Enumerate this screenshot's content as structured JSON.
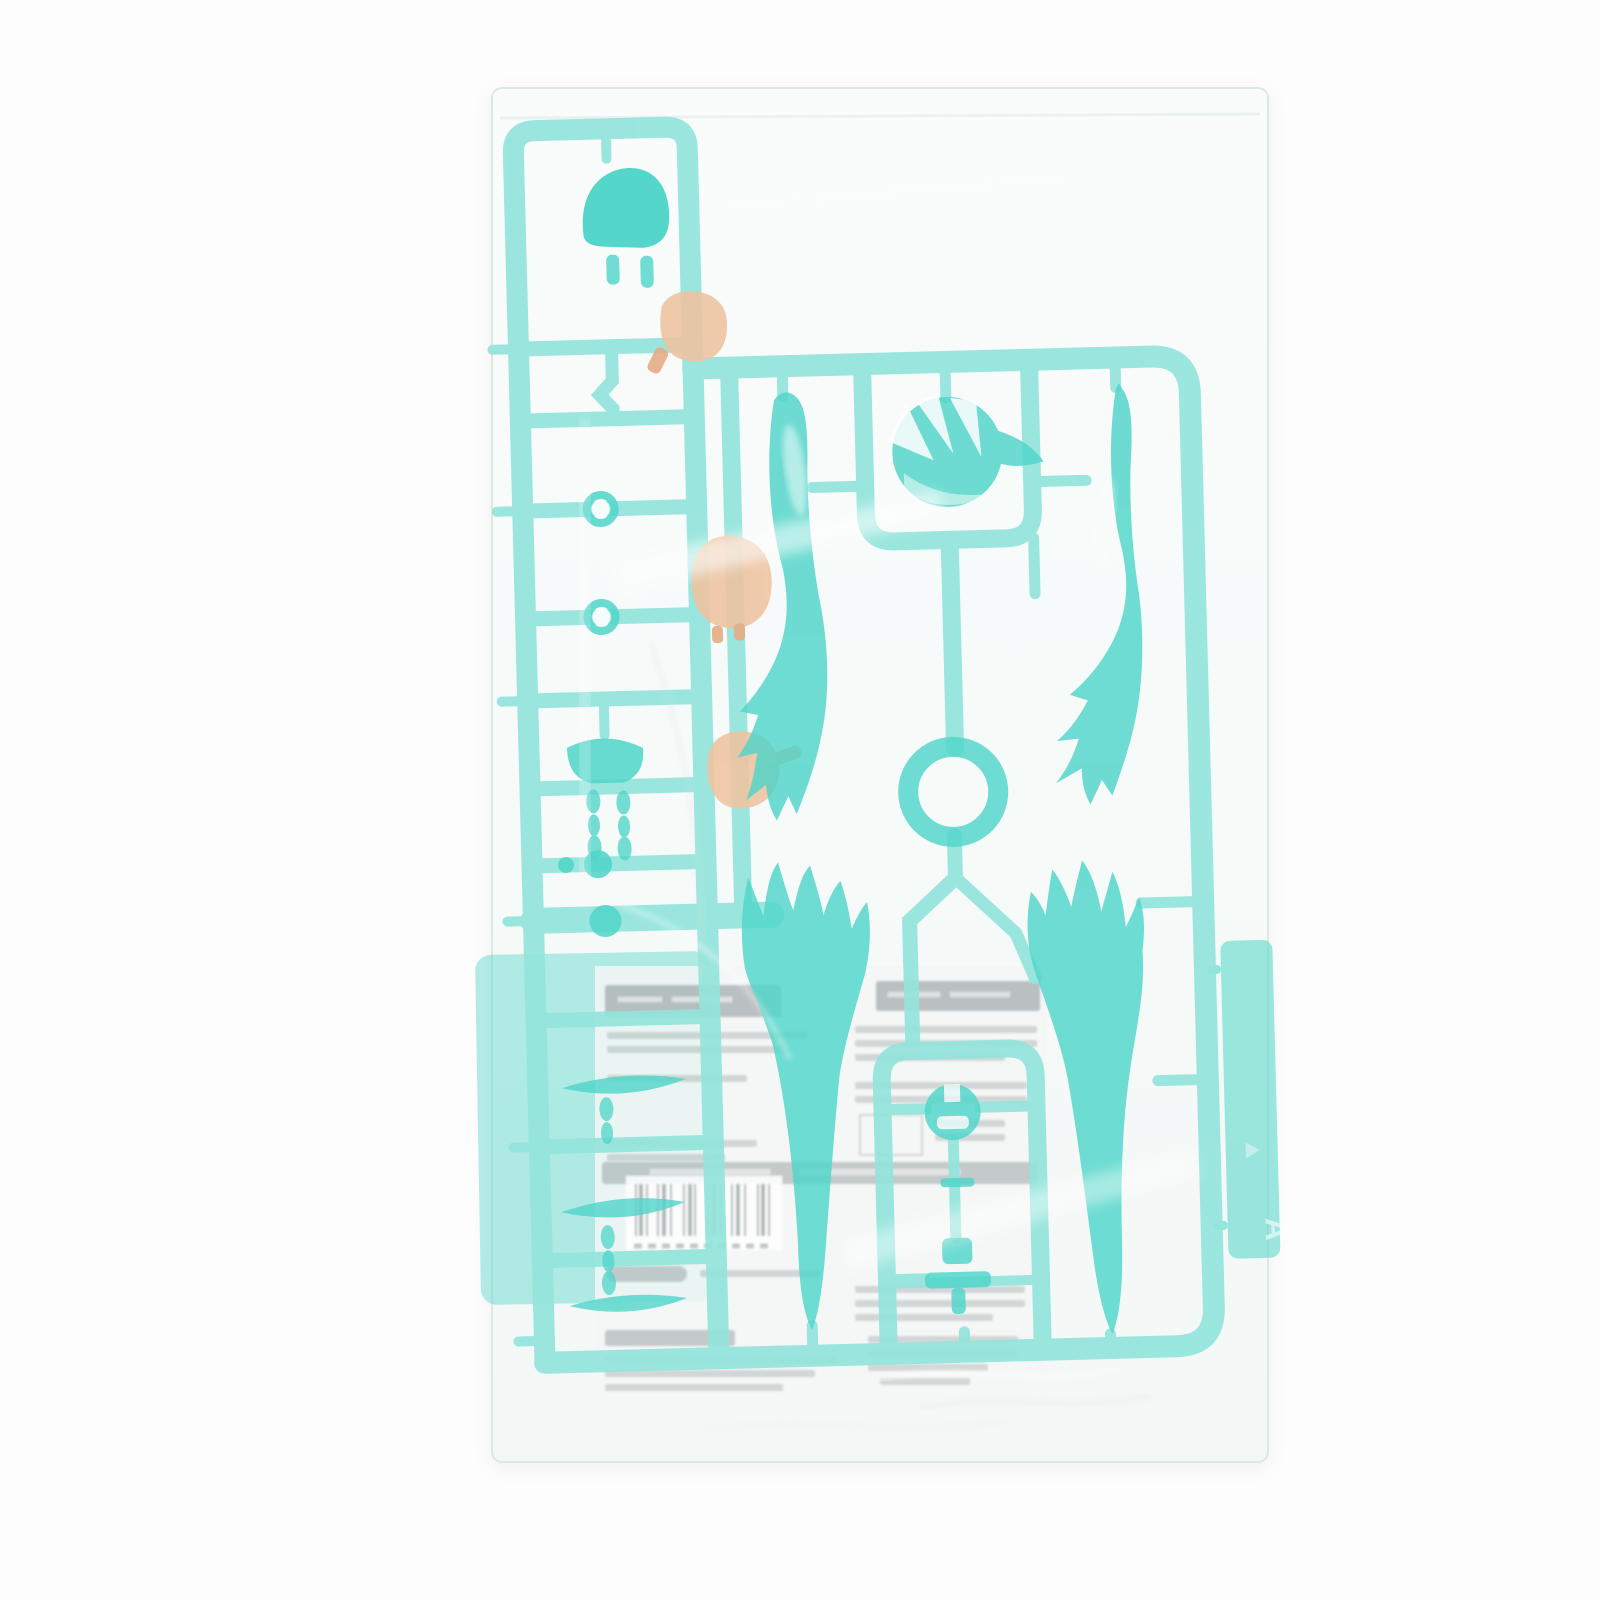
{
  "meta": {
    "title": "Sealed model-kit runner — product photo",
    "description": "Product photo of a translucent teal plastic model-kit runner (sprue A) sealed in a clear plastic bag. The runner carries anime-figure parts: a swirled front-hair piece, two long twin-tail hair pieces, two flame-shaped lower hair pieces, a round joint ring, a small hair clip and joint pieces, plus three skin-tone head parts. A folded instruction leaflet with a barcode shows through the bag, mirrored and illegible."
  },
  "colors": {
    "background": "#fdfdfd",
    "bag": "#f8fbfa",
    "bag_edge": "#dfe7e5",
    "rail": "#93e5dc",
    "part": "#4fd5c9",
    "part_deep": "#3ed0c4",
    "plate": "#5cd8cc",
    "skin": "#eec4a2",
    "skin_deep": "#e5ad84",
    "paper": "#f5f7f6",
    "ink": "#727d80",
    "barcode": "#414c4f",
    "highlight": "#ffffff"
  },
  "runner": {
    "tag_letter": "A"
  },
  "paper": {
    "barcode_visible": true,
    "text_legible": false
  }
}
